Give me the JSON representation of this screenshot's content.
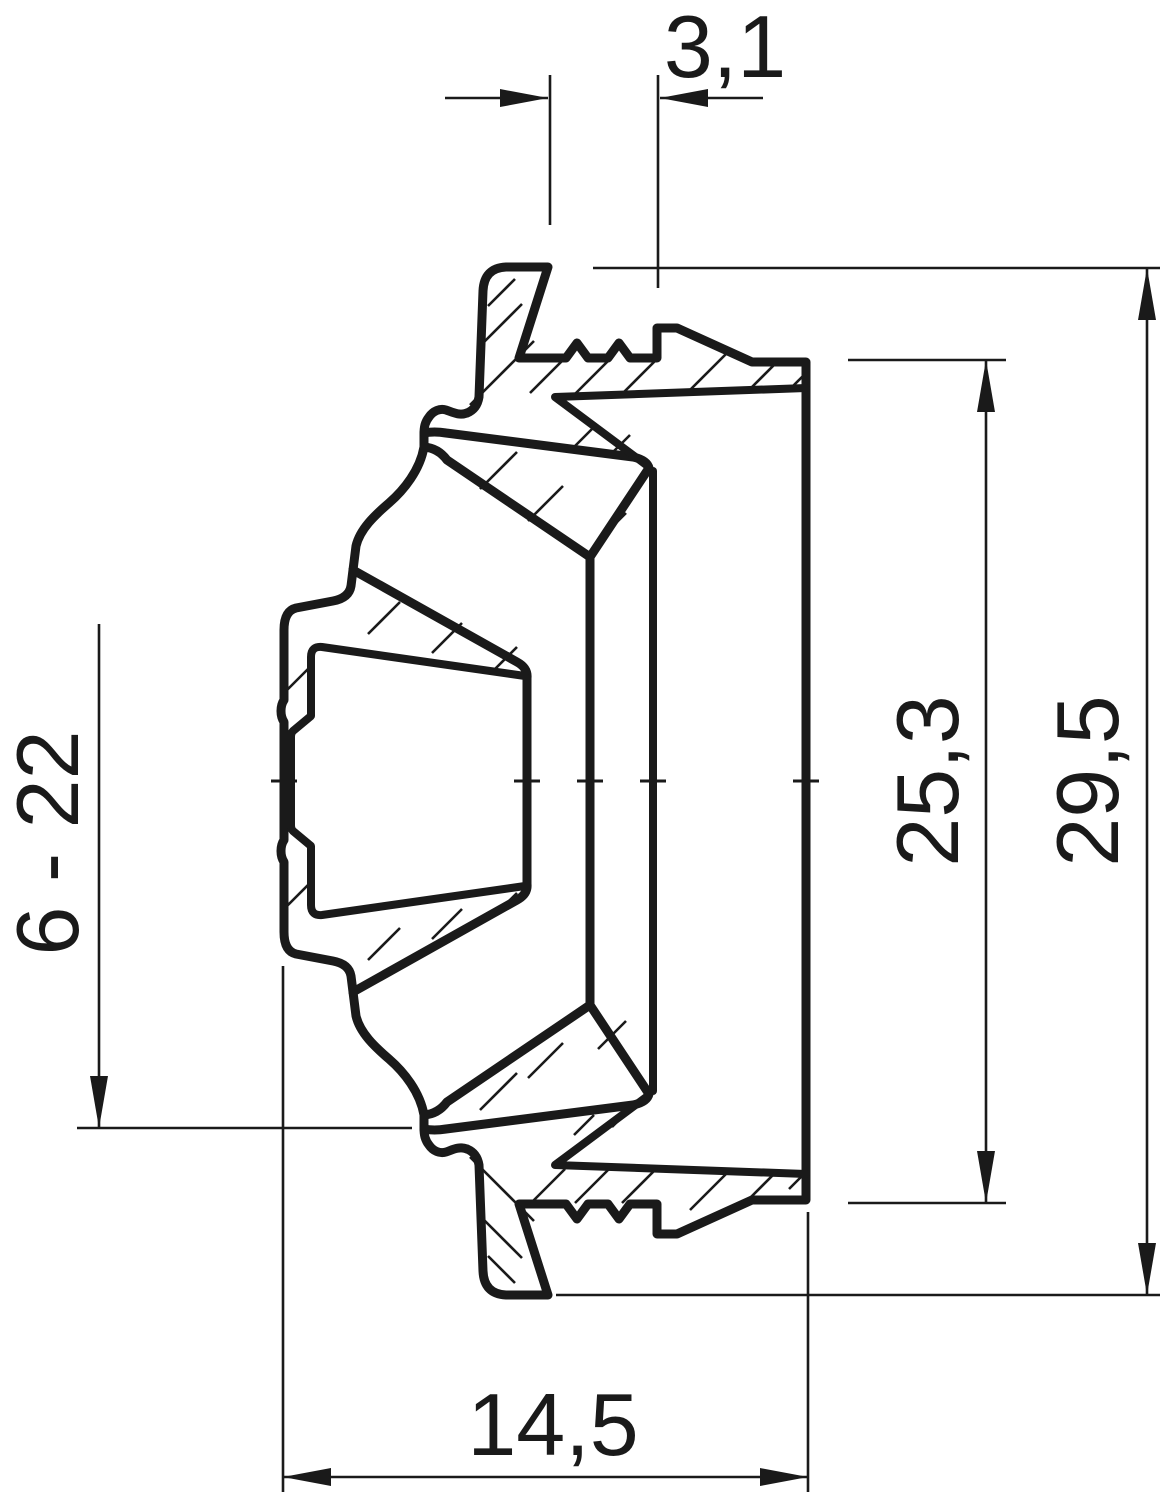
{
  "drawing": {
    "type": "technical-cross-section",
    "description": "Cross-section of a stepped conical membrane cable entry grommet with dimension callouts (values in mm)",
    "background_color": "#ffffff",
    "line_color": "#1a1a1a",
    "dimensions": {
      "step_wall_width": {
        "label": "3,1",
        "orientation": "horizontal",
        "position": "top"
      },
      "inner_height": {
        "label": "25,3",
        "orientation": "vertical",
        "position": "right-inner"
      },
      "outer_height": {
        "label": "29,5",
        "orientation": "vertical",
        "position": "right-outer"
      },
      "clamping_range": {
        "label": "6 - 22",
        "orientation": "vertical",
        "position": "left"
      },
      "depth": {
        "label": "14,5",
        "orientation": "horizontal",
        "position": "bottom"
      }
    }
  }
}
